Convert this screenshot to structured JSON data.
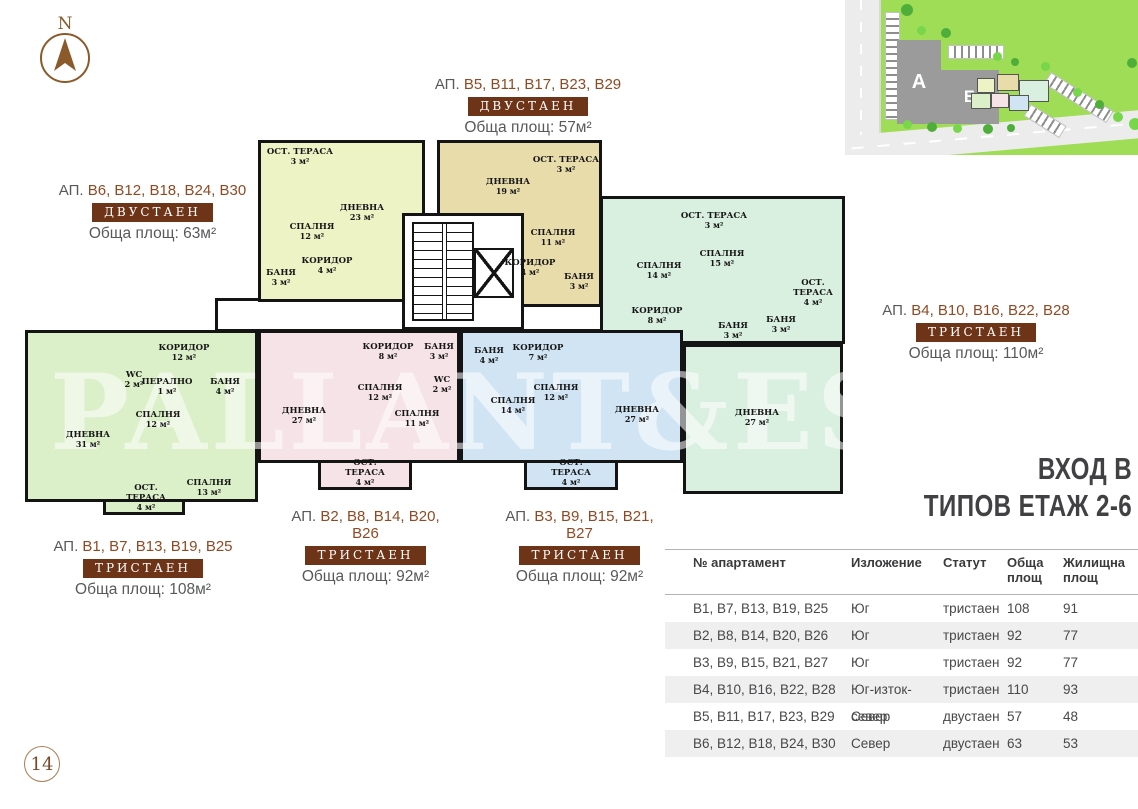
{
  "page": {
    "number": "14"
  },
  "compass": {
    "label": "N"
  },
  "watermark": "PALLANT&ES",
  "site_plan": {
    "building_a": "А",
    "building_b": "Б"
  },
  "plan_title": {
    "line1": "ВХОД В",
    "line2": "ТИПОВ ЕТАЖ 2-6"
  },
  "colors": {
    "accent_brown": "#6e3418",
    "unit_brown": "#8f4a24",
    "text_gray": "#58595b",
    "title_dark": "#414143",
    "apt_b6_fill": "#eef3c6",
    "apt_b5_fill": "#e9dcab",
    "apt_b4_fill": "#d9efdf",
    "apt_b1_fill": "#dbefc8",
    "apt_b2_fill": "#f5e3e7",
    "apt_b3_fill": "#d0e4f3"
  },
  "apartment_labels": [
    {
      "prefix": "АП.",
      "units": "B5, B11, B17, B23, B29",
      "type": "ДВУСТАЕН",
      "area": "Обща площ: 57м²"
    },
    {
      "prefix": "АП.",
      "units": "B6, B12, B18, B24, B30",
      "type": "ДВУСТАЕН",
      "area": "Обща площ: 63м²"
    },
    {
      "prefix": "АП.",
      "units": "B4, B10, B16, B22, B28",
      "type": "ТРИСТАЕН",
      "area": "Обща площ: 110м²"
    },
    {
      "prefix": "АП.",
      "units": "B1, B7, B13, B19, B25",
      "type": "ТРИСТАЕН",
      "area": "Обща площ: 108м²"
    },
    {
      "prefix": "АП.",
      "units": "B2, B8, B14, B20, B26",
      "type": "ТРИСТАЕН",
      "area": "Обща площ: 92м²"
    },
    {
      "prefix": "АП.",
      "units": "B3, B9, B15, B21, B27",
      "type": "ТРИСТАЕН",
      "area": "Обща площ: 92м²"
    }
  ],
  "floor_plan": {
    "apartments": [
      {
        "id": "B6",
        "rooms": [
          {
            "name": "ОСТ. ТЕРАСА",
            "area": "3 м²"
          },
          {
            "name": "ДНЕВНА",
            "area": "23 м²"
          },
          {
            "name": "СПАЛНЯ",
            "area": "12 м²"
          },
          {
            "name": "КОРИДОР",
            "area": "4 м²"
          },
          {
            "name": "БАНЯ",
            "area": "3 м²"
          }
        ]
      },
      {
        "id": "B5",
        "rooms": [
          {
            "name": "ДНЕВНА",
            "area": "19 м²"
          },
          {
            "name": "ОСТ. ТЕРАСА",
            "area": "3 м²"
          },
          {
            "name": "СПАЛНЯ",
            "area": "11 м²"
          },
          {
            "name": "КОРИДОР",
            "area": "4 м²"
          },
          {
            "name": "БАНЯ",
            "area": "3 м²"
          }
        ]
      },
      {
        "id": "B4",
        "rooms": [
          {
            "name": "ОСТ. ТЕРАСА",
            "area": "3 м²"
          },
          {
            "name": "СПАЛНЯ",
            "area": "15 м²"
          },
          {
            "name": "СПАЛНЯ",
            "area": "14 м²"
          },
          {
            "name": "ОСТ. ТЕРАСА",
            "area": "4 м²"
          },
          {
            "name": "КОРИДОР",
            "area": "8 м²"
          },
          {
            "name": "БАНЯ",
            "area": "3 м²"
          },
          {
            "name": "БАНЯ",
            "area": "3 м²"
          },
          {
            "name": "ДНЕВНА",
            "area": "27 м²"
          }
        ]
      },
      {
        "id": "B1",
        "rooms": [
          {
            "name": "КОРИДОР",
            "area": "12 м²"
          },
          {
            "name": "WC",
            "area": "2 м²"
          },
          {
            "name": "ПЕРАЛНО",
            "area": "1 м²"
          },
          {
            "name": "БАНЯ",
            "area": "4 м²"
          },
          {
            "name": "СПАЛНЯ",
            "area": "12 м²"
          },
          {
            "name": "ДНЕВНА",
            "area": "31 м²"
          },
          {
            "name": "СПАЛНЯ",
            "area": "13 м²"
          },
          {
            "name": "ОСТ. ТЕРАСА",
            "area": "4 м²"
          }
        ]
      },
      {
        "id": "B2",
        "rooms": [
          {
            "name": "КОРИДОР",
            "area": "8 м²"
          },
          {
            "name": "БАНЯ",
            "area": "3 м²"
          },
          {
            "name": "WC",
            "area": "2 м²"
          },
          {
            "name": "СПАЛНЯ",
            "area": "12 м²"
          },
          {
            "name": "ДНЕВНА",
            "area": "27 м²"
          },
          {
            "name": "СПАЛНЯ",
            "area": "11 м²"
          },
          {
            "name": "ОСТ. ТЕРАСА",
            "area": "4 м²"
          }
        ]
      },
      {
        "id": "B3",
        "rooms": [
          {
            "name": "БАНЯ",
            "area": "4 м²"
          },
          {
            "name": "КОРИДОР",
            "area": "7 м²"
          },
          {
            "name": "СПАЛНЯ",
            "area": "14 м²"
          },
          {
            "name": "СПАЛНЯ",
            "area": "12 м²"
          },
          {
            "name": "ДНЕВНА",
            "area": "27 м²"
          },
          {
            "name": "ОСТ. ТЕРАСА",
            "area": "4 м²"
          }
        ]
      }
    ]
  },
  "table": {
    "headers": [
      "№ апартамент",
      "Изложение",
      "Статут",
      "Обща площ",
      "Жилищна площ"
    ],
    "rows": [
      [
        "B1, B7, B13, B19, B25",
        "Юг",
        "тристаен",
        "108",
        "91"
      ],
      [
        "B2, B8, B14, B20, B26",
        "Юг",
        "тристаен",
        "92",
        "77"
      ],
      [
        "B3, B9, B15, B21, B27",
        "Юг",
        "тристаен",
        "92",
        "77"
      ],
      [
        "B4, B10, B16, B22, B28",
        "Юг-изток-север",
        "тристаен",
        "110",
        "93"
      ],
      [
        "B5, B11, B17, B23, B29",
        "Север",
        "двустаен",
        "57",
        "48"
      ],
      [
        "B6, B12, B18, B24, B30",
        "Север",
        "двустаен",
        "63",
        "53"
      ]
    ]
  }
}
